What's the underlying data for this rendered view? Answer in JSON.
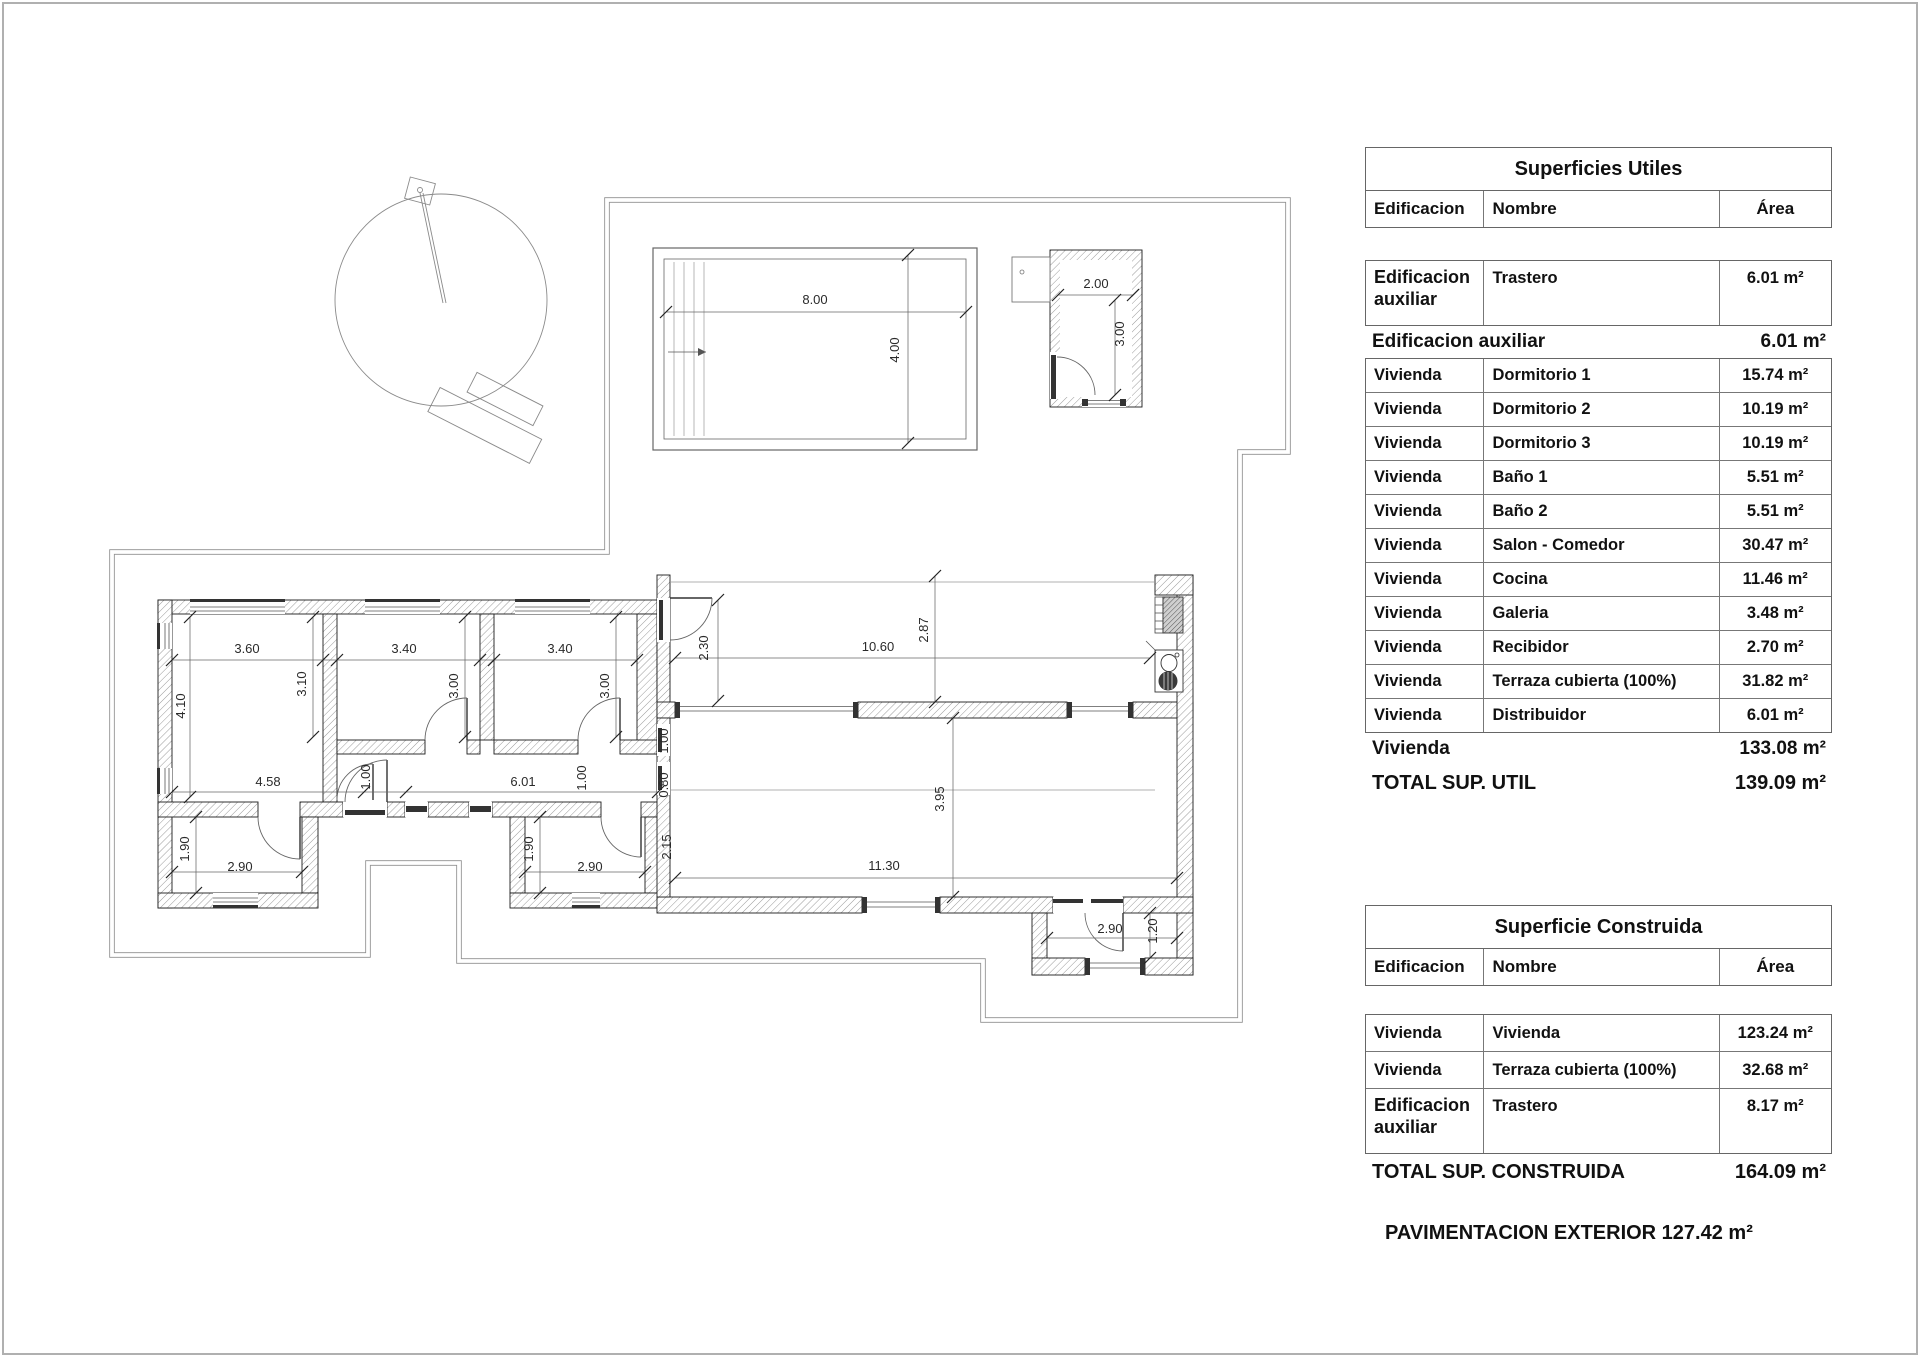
{
  "plan": {
    "dims": {
      "b1_w": "3.60",
      "b2_w": "3.40",
      "b3_w": "3.40",
      "b1_d": "4.10",
      "b1_d2": "3.10",
      "b2_d": "3.00",
      "b3_d": "3.00",
      "hall_a": "4.58",
      "hall_b": "1.00",
      "hall_c": "6.01",
      "hall_d": "1.00",
      "rec_a": "1.00",
      "rec_b": "0.80",
      "gal_d": "2.15",
      "bath1_d": "1.90",
      "bath1_w": "2.90",
      "bath2_d": "1.90",
      "bath2_w": "2.90",
      "ter_l": "2.30",
      "ter_w": "10.60",
      "ter_r": "2.87",
      "liv_w": "11.30",
      "liv_d": "3.95",
      "porch_w": "2.90",
      "porch_d": "1.20",
      "pool_w": "8.00",
      "pool_d": "4.00",
      "tras_w": "2.00",
      "tras_d": "3.00"
    }
  },
  "tables": {
    "utiles": {
      "title": "Superficies Utiles",
      "headers": {
        "edificacion": "Edificacion",
        "nombre": "Nombre",
        "area": "Área"
      },
      "group": {
        "e": "Edificacion auxiliar",
        "n": "Trastero",
        "a": "6.01 m²"
      },
      "subtotal_aux": {
        "label": "Edificacion auxiliar",
        "value": "6.01 m²"
      },
      "rows": [
        {
          "e": "Vivienda",
          "n": "Dormitorio 1",
          "a": "15.74 m²"
        },
        {
          "e": "Vivienda",
          "n": "Dormitorio 2",
          "a": "10.19 m²"
        },
        {
          "e": "Vivienda",
          "n": "Dormitorio 3",
          "a": "10.19 m²"
        },
        {
          "e": "Vivienda",
          "n": "Baño 1",
          "a": "5.51 m²"
        },
        {
          "e": "Vivienda",
          "n": "Baño 2",
          "a": "5.51 m²"
        },
        {
          "e": "Vivienda",
          "n": "Salon - Comedor",
          "a": "30.47 m²"
        },
        {
          "e": "Vivienda",
          "n": "Cocina",
          "a": "11.46 m²"
        },
        {
          "e": "Vivienda",
          "n": "Galeria",
          "a": "3.48 m²"
        },
        {
          "e": "Vivienda",
          "n": "Recibidor",
          "a": "2.70 m²"
        },
        {
          "e": "Vivienda",
          "n": "Terraza cubierta (100%)",
          "a": "31.82 m²"
        },
        {
          "e": "Vivienda",
          "n": "Distribuidor",
          "a": "6.01 m²"
        }
      ],
      "subtotal_viv": {
        "label": "Vivienda",
        "value": "133.08 m²"
      },
      "total": {
        "label": "TOTAL SUP. UTIL",
        "value": "139.09 m²"
      }
    },
    "construida": {
      "title": "Superficie Construida",
      "headers": {
        "edificacion": "Edificacion",
        "nombre": "Nombre",
        "area": "Área"
      },
      "rows": [
        {
          "e": "Vivienda",
          "n": "Vivienda",
          "a": "123.24 m²"
        },
        {
          "e": "Vivienda",
          "n": "Terraza cubierta (100%)",
          "a": "32.68 m²"
        },
        {
          "e": "Edificacion auxiliar",
          "n": "Trastero",
          "a": "8.17 m²"
        }
      ],
      "total": {
        "label": "TOTAL SUP. CONSTRUIDA",
        "value": "164.09 m²"
      }
    },
    "footer": {
      "text": "PAVIMENTACION EXTERIOR 127.42 m²"
    }
  }
}
